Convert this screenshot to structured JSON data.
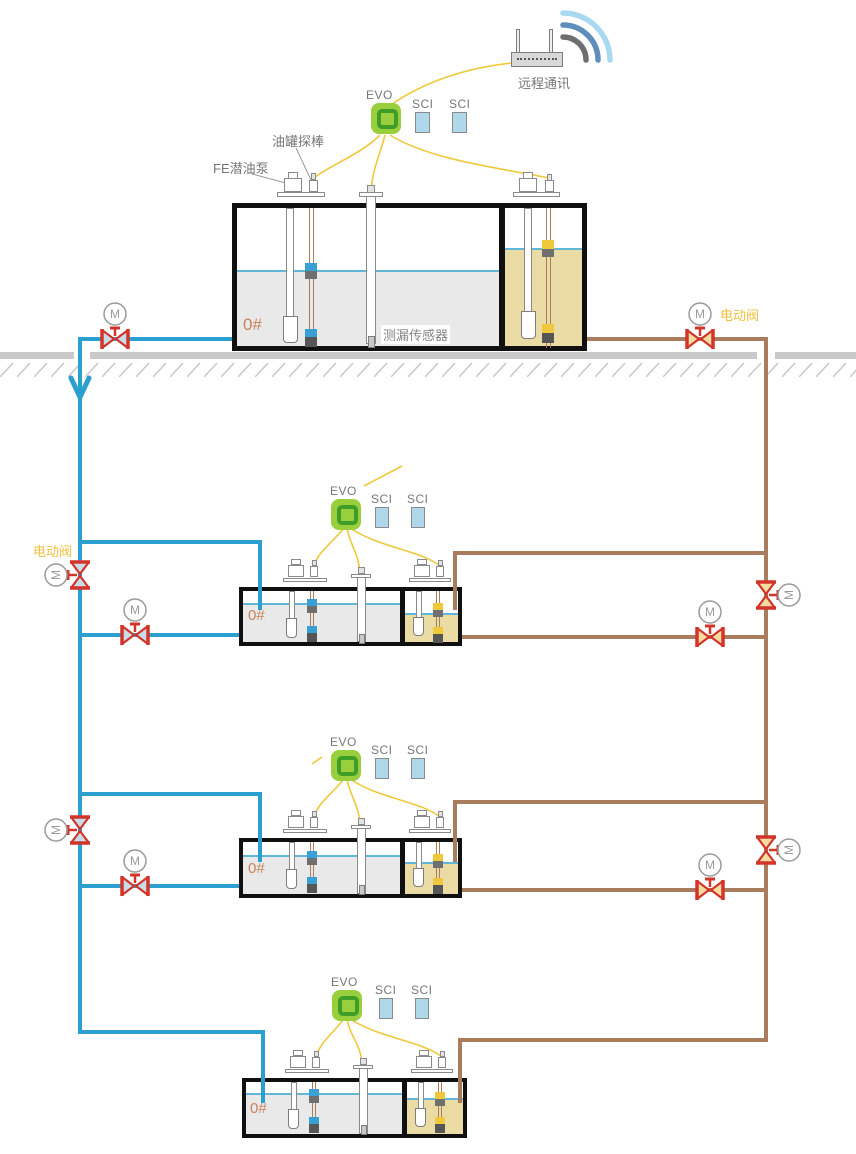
{
  "remote": {
    "label": "远程通讯"
  },
  "labels": {
    "motor": "M",
    "electric_valve": "电动阀",
    "tank_probe": "油罐探棒",
    "submersible_pump": "FE潜油泵",
    "leak_sensor": "测漏传感器"
  },
  "stations": [
    {
      "evo": "EVO",
      "sci1": "SCI",
      "sci2": "SCI",
      "tank_label": "0#"
    },
    {
      "evo": "EVO",
      "sci1": "SCI",
      "sci2": "SCI",
      "tank_label": "0#"
    },
    {
      "evo": "EVO",
      "sci1": "SCI",
      "sci2": "SCI",
      "tank_label": "0#"
    },
    {
      "evo": "EVO",
      "sci1": "SCI",
      "sci2": "SCI",
      "tank_label": "0#"
    }
  ],
  "colors": {
    "pipe_blue": "#2B9FD0",
    "pipe_brown": "#A87C5C",
    "valve_red": "#D2342A",
    "valve_fill_blue": "#C9DDE9",
    "valve_fill_tan": "#F7DCA2",
    "liquid_gray": "#E9E9E9",
    "liquid_tan": "#EBDBA4",
    "liquid_line_blue": "#5FB6D6",
    "evo_green": "#99CE3C",
    "evo_ring_green": "#3E9E27",
    "sci_blue": "#AFD9EA",
    "wire_yellow": "#EFC83C",
    "ground_gray": "#C9C9C9",
    "label_gray": "#777777",
    "label_orange": "#EFBE3C",
    "tank_text_orange": "#C8825A"
  }
}
